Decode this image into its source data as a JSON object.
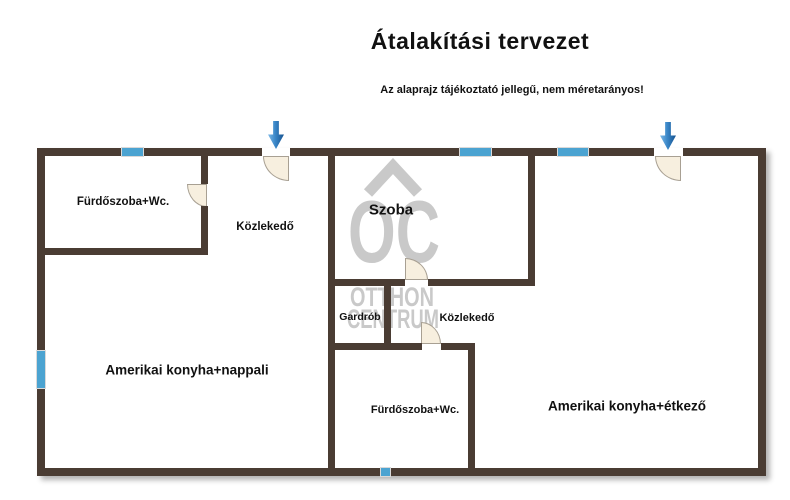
{
  "header": {
    "title": "Átalakítási tervezet",
    "disclaimer": "Az alaprajz tájékoztató jellegű, nem méretarányos!"
  },
  "rooms": {
    "bathroom_top": {
      "label": "Fürdőszoba+Wc."
    },
    "hallway_top": {
      "label": "Közlekedő"
    },
    "bedroom": {
      "label": "Szoba"
    },
    "wardrobe": {
      "label": "Gardrób"
    },
    "hallway_lower": {
      "label": "Közlekedő"
    },
    "bathroom_lower": {
      "label": "Fürdőszoba+Wc."
    },
    "kitchen_living": {
      "label": "Amerikai konyha+nappali"
    },
    "kitchen_dining": {
      "label": "Amerikai konyha+étkező"
    }
  },
  "watermark": {
    "monogram": "OC",
    "line1": "OTTHON",
    "line2": "CENTRUM"
  },
  "colors": {
    "wall": "#4a3c33",
    "window": "#4ba3d1",
    "door_fill": "#f7efdf",
    "door_border": "#a8a093",
    "arrow": "#2273b9",
    "watermark": "#c9c9c9"
  }
}
